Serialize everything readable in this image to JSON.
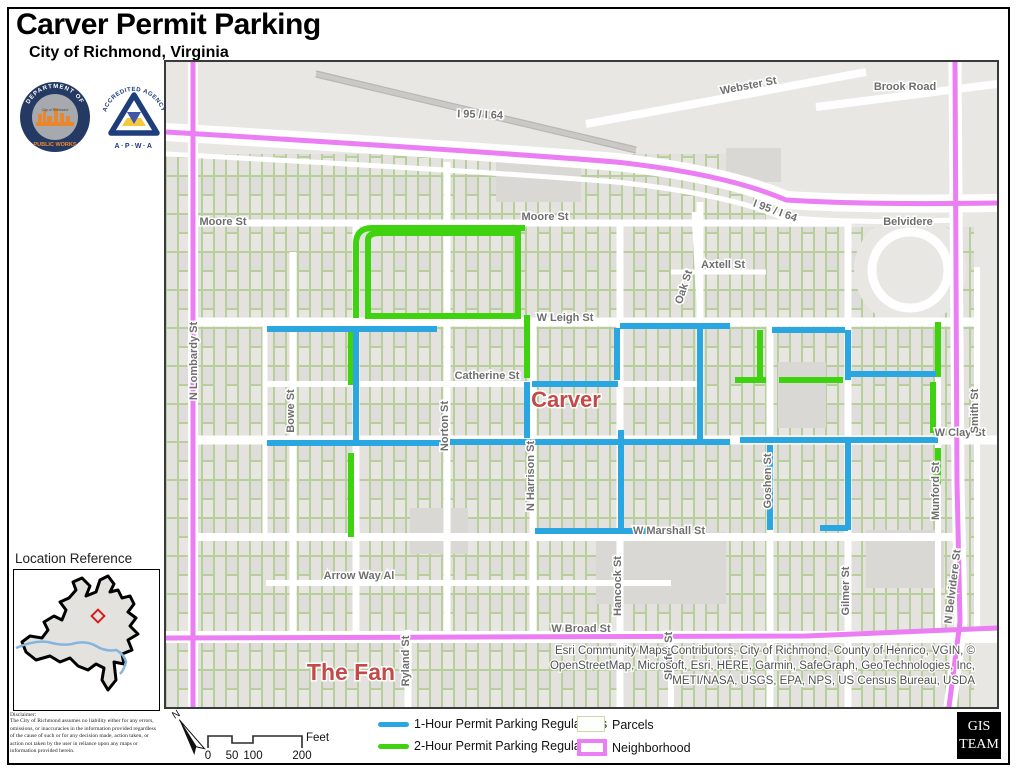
{
  "page": {
    "title": "Carver Permit Parking",
    "subtitle": "City of Richmond, Virginia"
  },
  "logos": {
    "dpw": {
      "arc_top": "DEPARTMENT OF",
      "bottom": "PUBLIC WORKS",
      "center": "City of Richmond"
    },
    "apwa": {
      "arc_top": "ACCREDITED AGENCY",
      "bottom": "A·P·W·A"
    }
  },
  "map": {
    "labels": {
      "webster": "Webster St",
      "brook_road": "Brook Road",
      "i95": "I 95 / I 64",
      "moore": "Moore St",
      "belvidere": "Belvidere",
      "axtell": "Axtell St",
      "oak": "Oak St",
      "leigh": "W Leigh St",
      "catherine": "Catherine St",
      "clay": "W Clay St",
      "smith": "Smith St",
      "lombardy": "N Lombardy St",
      "bowe": "Bowe St",
      "norton": "Norton St",
      "harrison": "N Harrison St",
      "hancock": "Hancock St",
      "goshen": "Goshen St",
      "gilmer": "Gilmer St",
      "munford": "Munford St",
      "n_belvidere": "N Belvidere St",
      "marshall": "W Marshall St",
      "arrow_way": "Arrow Way Al",
      "broad": "W Broad St",
      "ryland": "Ryland St",
      "shafer": "Shafer St"
    },
    "area_labels": {
      "carver": "Carver",
      "the_fan": "The Fan"
    },
    "attribution": [
      "Esri Community Maps Contributors, City of Richmond, County of Henrico, VGIN, ©",
      "OpenStreetMap, Microsoft, Esri, HERE, Garmin, SafeGraph, GeoTechnologies, Inc,",
      "METI/NASA, USGS, EPA, NPS, US Census Bureau, USDA"
    ]
  },
  "location_reference": {
    "title": "Location Reference"
  },
  "disclaimer": {
    "title": "Disclaimer:",
    "body": "The City of Richmond assumes no liability either for any errors, omissions, or inaccuracies in the information provided regardless of the cause of such or for any decision made, action taken, or action not taken by the user in reliance upon any maps or information provided herein."
  },
  "legend": {
    "items": [
      {
        "label": "1-Hour Permit Parking Regulations"
      },
      {
        "label": "2-Hour Permit Parking Regulations"
      },
      {
        "label": "Parcels"
      },
      {
        "label": "Neighborhood"
      }
    ],
    "scale": {
      "ticks": [
        "0",
        "50",
        "100",
        "200"
      ],
      "unit": "Feet"
    },
    "north_label": "N"
  },
  "gis_team": {
    "line1": "GIS",
    "line2": "TEAM"
  },
  "colors": {
    "one_hour": "#2aa7e0",
    "two_hour": "#3ed30e",
    "neighborhood": "#ea7ef2",
    "parcel_outline": "#b9cf9b",
    "street_label": "#6e6e6e",
    "area_label": "#c34a48"
  }
}
